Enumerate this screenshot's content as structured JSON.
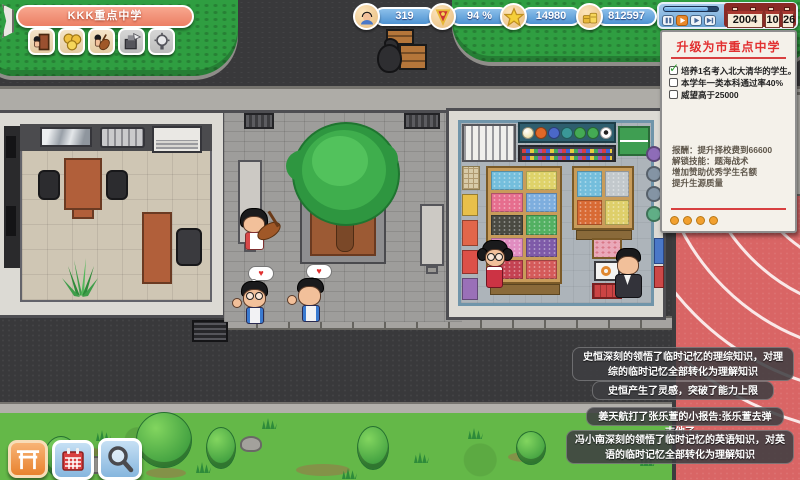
{
  "header": {
    "school_banner": "KKK重点中学",
    "toolbar": {
      "icons": [
        "door-person",
        "coins",
        "music-student",
        "printer",
        "idea-bulb"
      ]
    },
    "resources": [
      {
        "icon": "student-avatar",
        "value": "319"
      },
      {
        "icon": "red-pennant",
        "value": "94 %"
      },
      {
        "icon": "gold-star",
        "value": "14980"
      },
      {
        "icon": "gold-coins",
        "value": "812597"
      }
    ],
    "time_control": {
      "buttons": [
        "pause",
        "play-active",
        "play-fast",
        "step"
      ],
      "date": {
        "year": "2004",
        "month": "10",
        "day": "26"
      }
    }
  },
  "quest_panel": {
    "title": "升级为市重点中学",
    "objectives": [
      {
        "checked": true,
        "text": "培养1名考入北大清华的学生。"
      },
      {
        "checked": false,
        "text": "本学年一类本科通过率40%"
      },
      {
        "checked": false,
        "text": "威望高于25000"
      }
    ],
    "rewards": [
      "报酬：提升择校费到66600",
      "解锁技能：题海战术",
      "增加赞助优秀学生名额",
      "提升生源质量"
    ],
    "pager_dots": 4
  },
  "messages": [
    "史恒深刻的领悟了临时记忆的理综知识，对理综的临时记忆全部转化为理解知识",
    "史恒产生了灵感，突破了能力上限",
    "姜天航打了张乐萱的小报告:张乐萱去弹吉他了。",
    "冯小南深刻的领悟了临时记忆的英语知识，对英语的临时记忆全部转化为理解知识"
  ],
  "footer": {
    "buttons": [
      "school-gate",
      "calendar",
      "magnifier"
    ]
  },
  "colors": {
    "accent_red": "#e23030",
    "ui_blue": "#5b9bd8",
    "banner": "#ef8f76",
    "track": "#d96565",
    "grass": "#64b848"
  },
  "heart": "♥"
}
